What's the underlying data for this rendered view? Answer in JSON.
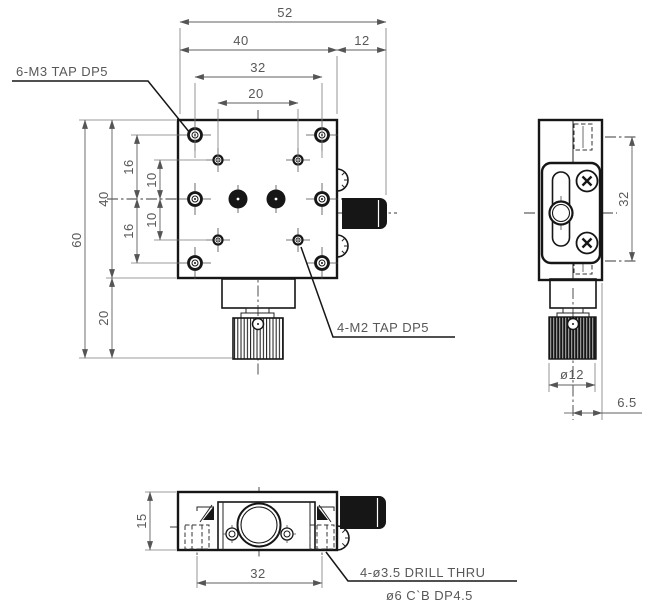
{
  "meta": {
    "colors": {
      "line": "#161616",
      "dim_text": "#585858"
    }
  },
  "labels": {
    "m3_tap": "6-M3 TAP DP5",
    "m2_tap": "4-M2 TAP DP5",
    "drill_thru": "4-ø3.5 DRILL THRU",
    "counterbore": "ø6 C`B DP4.5"
  },
  "front_view": {
    "top_dims": {
      "overall_width": "52",
      "body_width": "40",
      "knob_ext": "12",
      "m3_hole_span": "32",
      "m2_hole_span": "20"
    },
    "left_dims": {
      "overall_height": "60",
      "body_height": "40",
      "knob_height": "20",
      "m3_row_upper": "16",
      "m3_row_lower": "16",
      "m2_row_upper": "10",
      "m2_row_lower": "10"
    }
  },
  "side_view": {
    "dims": {
      "side_hole_span": "32",
      "knob_diameter": "ø12",
      "knob_offset": "6.5"
    }
  },
  "bottom_view": {
    "dims": {
      "thickness": "15",
      "mount_hole_span": "32"
    }
  }
}
